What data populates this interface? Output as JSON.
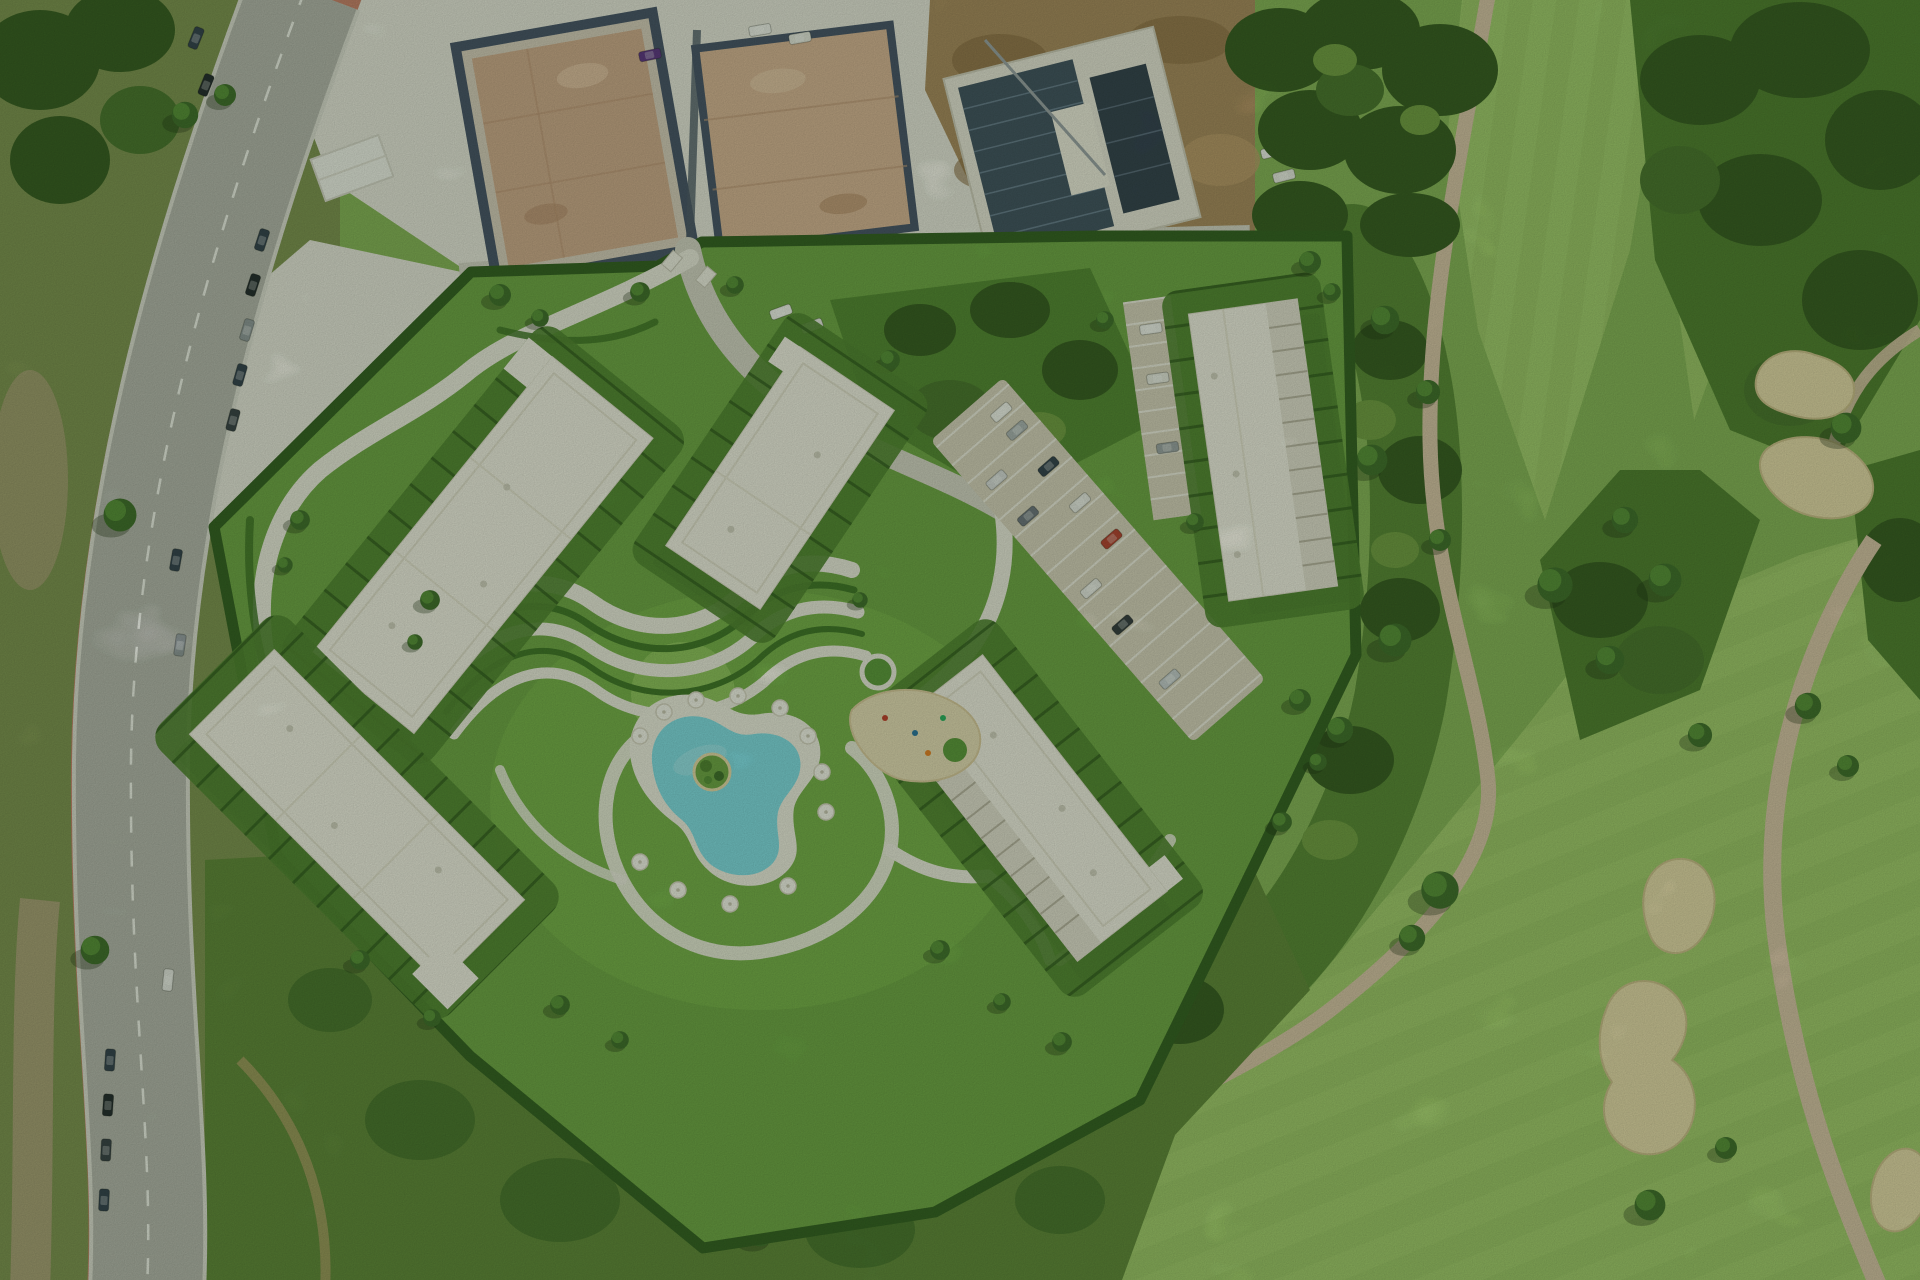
{
  "scene": {
    "kind": "aerial photograph",
    "alt": "Aerial view of a rendered residential resort development: five white apartment buildings with terraced gardens, winding white footpaths, a turquoise free-form swimming pool with white parasols, and a central parking area, bounded by a curving road with red cycle lanes on the left, construction sites with building foundations at the top, and a golf course with sand bunkers and cart paths on the right."
  },
  "palette": {
    "scrub": "#7c8f50",
    "scrub_outside": "#5d8338",
    "gravel": "#e9e7e0",
    "dirt": "#a8885e",
    "asphalt": "#b4b5af",
    "lane_red": "#c97f6b",
    "site_lawn": "#6ca344",
    "hedge": "#2f5a1f",
    "internal_road": "#d6d3c9",
    "parking": "#d8d1c0",
    "roof": "#f3f0e8",
    "pool": "#7edbe8",
    "deck": "#f0ede4",
    "golf_base": "#85b258",
    "fairway": "#9cc468",
    "sand": "#e6d8ab",
    "cart_path": "#d9c2a9"
  }
}
